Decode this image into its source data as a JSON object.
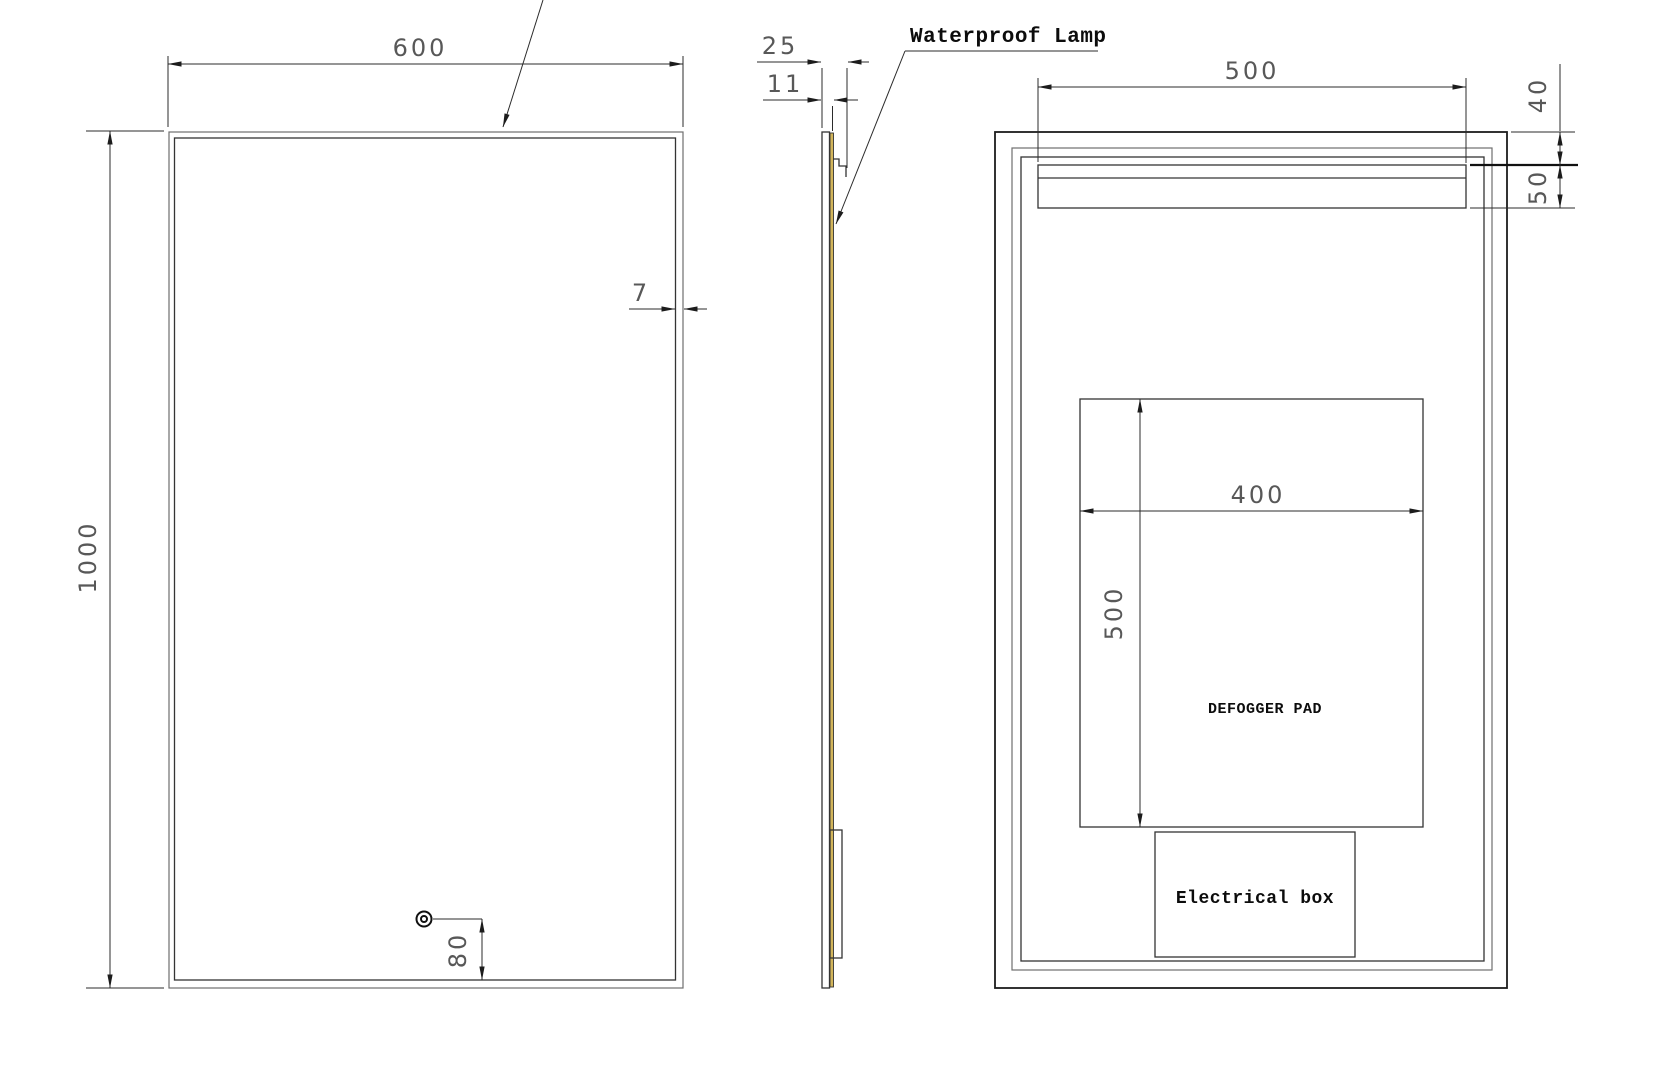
{
  "drawing": {
    "front_view": {
      "width_dim": "600",
      "height_dim": "1000",
      "frame_inset_dim": "7",
      "sensor_height_dim": "80"
    },
    "side_view": {
      "total_depth_dim": "25",
      "glass_depth_dim": "11"
    },
    "back_view": {
      "lamp_width_dim": "500",
      "lamp_top_offset_dim": "40",
      "lamp_height_dim": "50",
      "defogger_width_dim": "400",
      "defogger_height_dim": "500",
      "defogger_label": "DEFOGGER PAD",
      "electrical_box_label": "Electrical box"
    },
    "annotations": {
      "waterproof_lamp_label": "Waterproof Lamp"
    },
    "colors": {
      "line": "#1c1c1c",
      "dim_text": "#585858",
      "lamp_strip": "#d2b55b",
      "background": "#ffffff"
    }
  }
}
